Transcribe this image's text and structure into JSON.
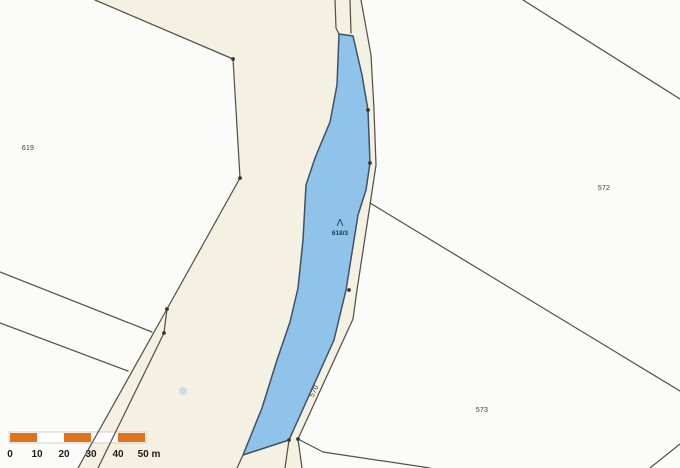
{
  "map": {
    "width": 680,
    "height": 468,
    "colors": {
      "road_fill": "#f4f1e2",
      "parcel_fill": "#fbfbf9",
      "highlight_fill": "#8fc3ea",
      "highlight_stroke": "#3e5166",
      "boundary_stroke": "#55524a",
      "vertex_fill": "#38382f",
      "label_color": "#3a3a36",
      "highlight_label_color": "#223750",
      "water_dot_fill": "#badcec"
    },
    "parcels": [
      {
        "id": "619",
        "role": "parcel",
        "points": [
          [
            0,
            0
          ],
          [
            95,
            0
          ],
          [
            233,
            59
          ],
          [
            240,
            178
          ],
          [
            167,
            309
          ],
          [
            78,
            468
          ],
          [
            0,
            468
          ]
        ]
      },
      {
        "id": "east-block",
        "role": "parcel",
        "points": [
          [
            361,
            0
          ],
          [
            680,
            0
          ],
          [
            680,
            468
          ],
          [
            302,
            468
          ],
          [
            298,
            439
          ],
          [
            353,
            319
          ],
          [
            357,
            290
          ],
          [
            370,
            205
          ],
          [
            376,
            165
          ],
          [
            374,
            110
          ],
          [
            371,
            55
          ]
        ]
      },
      {
        "id": "618-3",
        "role": "highlight",
        "points": [
          [
            339,
            34
          ],
          [
            353,
            36
          ],
          [
            362,
            75
          ],
          [
            368,
            110
          ],
          [
            370,
            163
          ],
          [
            366,
            190
          ],
          [
            358,
            215
          ],
          [
            350,
            265
          ],
          [
            346,
            290
          ],
          [
            334,
            340
          ],
          [
            289,
            440
          ],
          [
            243,
            455
          ],
          [
            262,
            408
          ],
          [
            277,
            360
          ],
          [
            290,
            322
          ],
          [
            298,
            288
          ],
          [
            303,
            240
          ],
          [
            306,
            185
          ],
          [
            315,
            158
          ],
          [
            330,
            122
          ],
          [
            337,
            85
          ]
        ]
      }
    ],
    "boundaries": [
      {
        "id": "north-619",
        "points": [
          [
            95,
            0
          ],
          [
            233,
            59
          ],
          [
            240,
            178
          ],
          [
            167,
            309
          ]
        ]
      },
      {
        "id": "strip-west",
        "points": [
          [
            167,
            309
          ],
          [
            78,
            468
          ]
        ]
      },
      {
        "id": "strip-east",
        "points": [
          [
            167,
            309
          ],
          [
            164,
            333
          ],
          [
            98,
            468
          ]
        ]
      },
      {
        "id": "west-branch-1",
        "points": [
          [
            0,
            272
          ],
          [
            152,
            332
          ]
        ]
      },
      {
        "id": "west-branch-2",
        "points": [
          [
            0,
            323
          ],
          [
            128,
            371
          ]
        ]
      },
      {
        "id": "path-top-1",
        "points": [
          [
            335,
            0
          ],
          [
            336,
            28
          ],
          [
            339,
            34
          ]
        ]
      },
      {
        "id": "path-top-2",
        "points": [
          [
            350,
            0
          ],
          [
            351,
            33
          ]
        ]
      },
      {
        "id": "path-east",
        "points": [
          [
            361,
            0
          ],
          [
            371,
            55
          ],
          [
            374,
            110
          ],
          [
            376,
            165
          ],
          [
            370,
            205
          ],
          [
            357,
            290
          ],
          [
            353,
            319
          ],
          [
            298,
            439
          ]
        ]
      },
      {
        "id": "ne-diagonal",
        "points": [
          [
            523,
            0
          ],
          [
            680,
            99
          ]
        ]
      },
      {
        "id": "572-573-boundary",
        "points": [
          [
            370,
            203
          ],
          [
            680,
            391
          ]
        ]
      },
      {
        "id": "se-corner",
        "points": [
          [
            680,
            444
          ],
          [
            650,
            468
          ]
        ]
      },
      {
        "id": "junction-south",
        "points": [
          [
            298,
            439
          ],
          [
            302,
            468
          ]
        ]
      },
      {
        "id": "junction-southeast",
        "points": [
          [
            298,
            439
          ],
          [
            323,
            452
          ],
          [
            430,
            468
          ]
        ]
      },
      {
        "id": "blue-tail-west",
        "points": [
          [
            243,
            455
          ],
          [
            237,
            468
          ]
        ]
      },
      {
        "id": "blue-tail-east",
        "points": [
          [
            289,
            440
          ],
          [
            285,
            468
          ]
        ]
      }
    ],
    "vertices": [
      [
        233,
        59
      ],
      [
        240,
        178
      ],
      [
        167,
        309
      ],
      [
        164,
        333
      ],
      [
        368,
        110
      ],
      [
        370,
        163
      ],
      [
        349,
        290
      ],
      [
        298,
        439
      ],
      [
        289,
        440
      ]
    ],
    "labels": [
      {
        "text": "619",
        "x": 28,
        "y": 150,
        "rotation": 0,
        "role": "parcel"
      },
      {
        "text": "572",
        "x": 604,
        "y": 190,
        "rotation": 0,
        "role": "parcel"
      },
      {
        "text": "573",
        "x": 482,
        "y": 412,
        "rotation": 0,
        "role": "parcel"
      },
      {
        "text": "570",
        "x": 316,
        "y": 392,
        "rotation": -65,
        "role": "parcel"
      },
      {
        "text": "618/3",
        "x": 340,
        "y": 235,
        "rotation": 0,
        "role": "highlight"
      }
    ],
    "symbols": [
      {
        "glyph": "Λ",
        "x": 340,
        "y": 226,
        "name": "landuse-symbol"
      }
    ],
    "water_dot": {
      "x": 183,
      "y": 391,
      "r": 4
    }
  },
  "scalebar": {
    "x": 10,
    "y": 433,
    "height": 9,
    "segment_width": 27,
    "segments": [
      "orange",
      "white",
      "orange",
      "white",
      "orange"
    ],
    "orange": "#e0731d",
    "white": "#ffffff",
    "border": "#c9c6bc",
    "tick_labels": [
      "0",
      "10",
      "20",
      "30",
      "40",
      "50 m"
    ],
    "label_color": "#1c1c1c",
    "label_y": 457
  }
}
